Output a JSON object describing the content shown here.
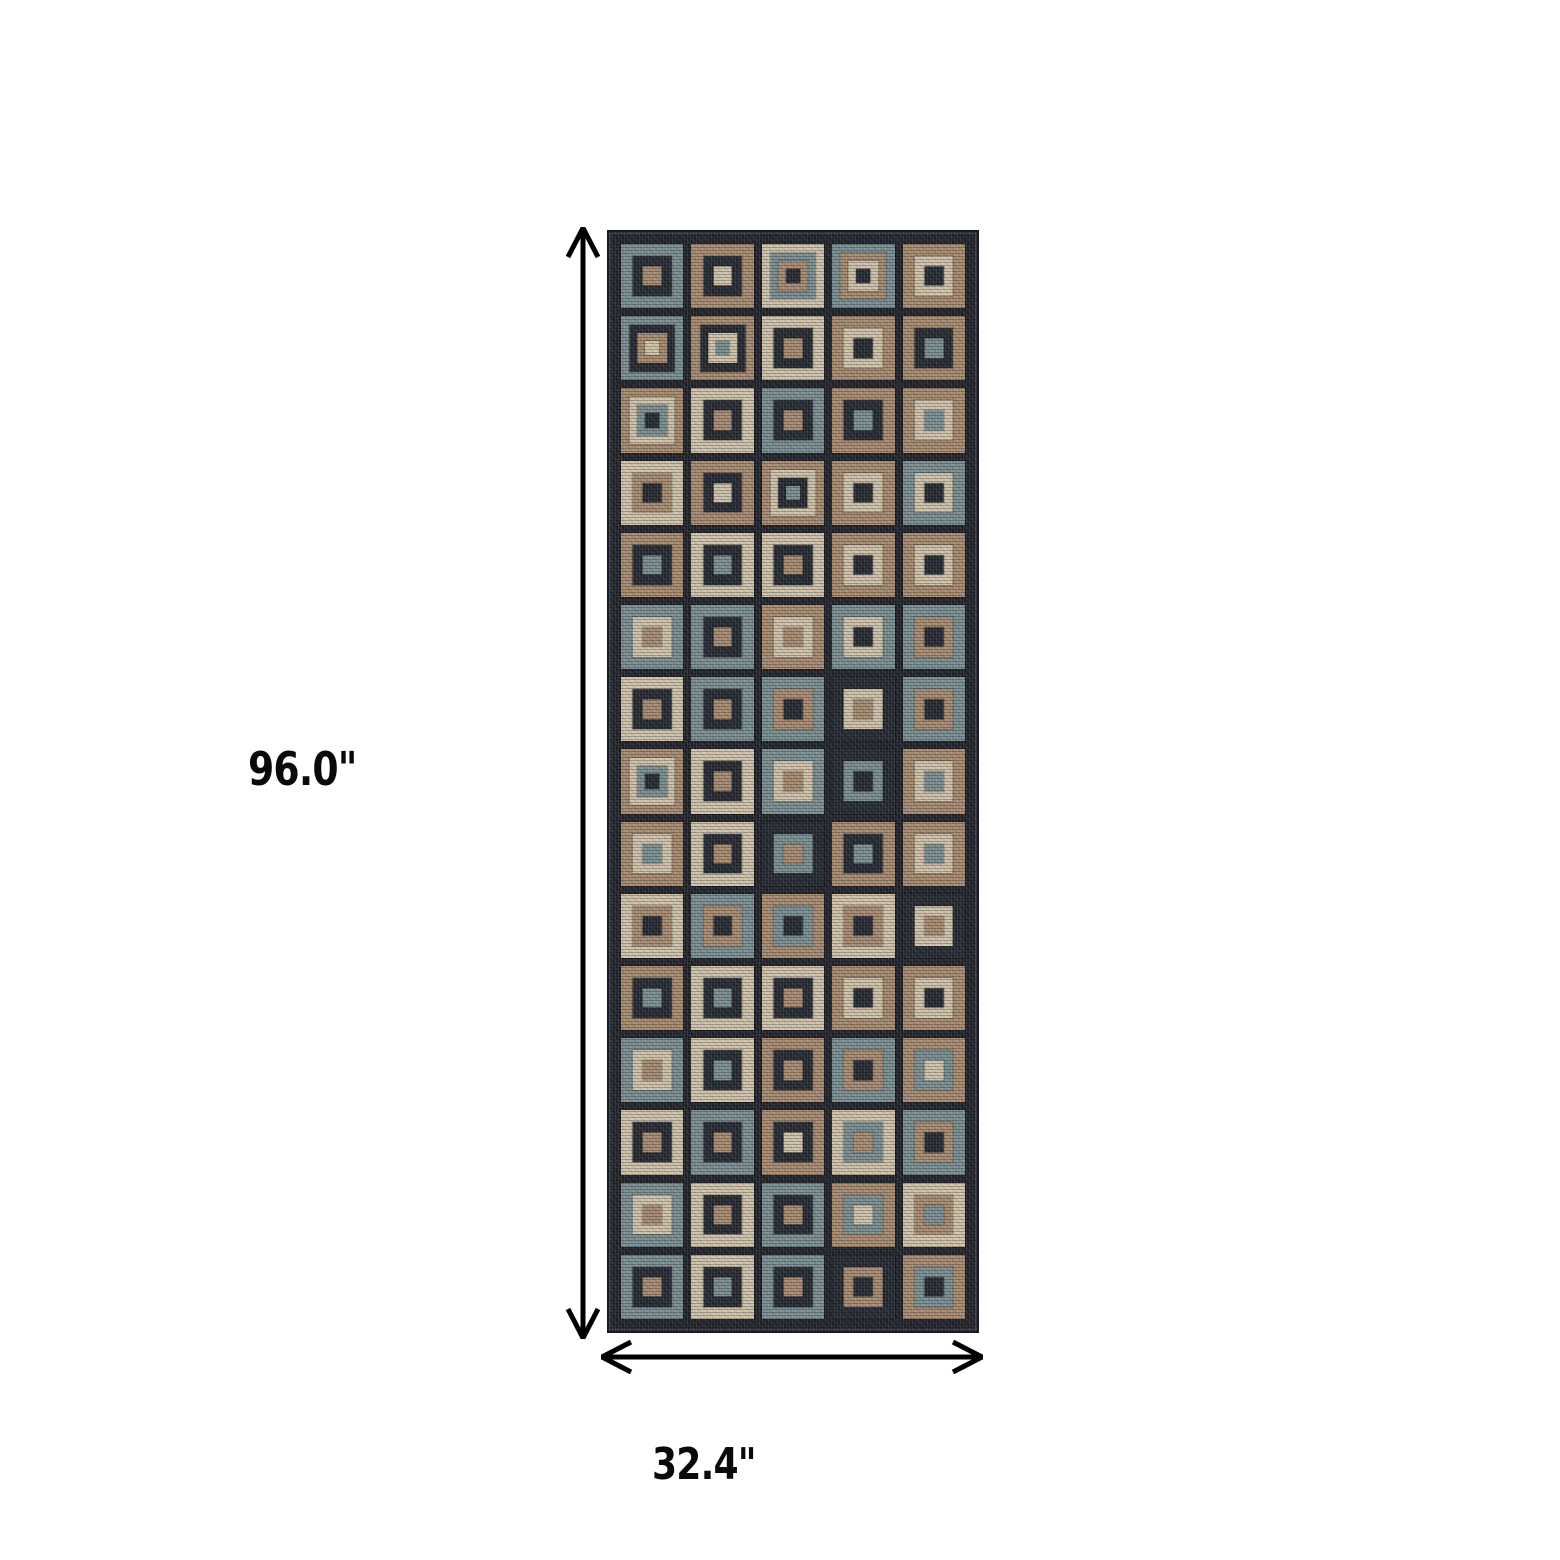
{
  "page": {
    "background": "#ffffff"
  },
  "labels": {
    "height": "96.0\"",
    "width": "32.4\""
  },
  "arrows": {
    "color": "#000000",
    "style": "double-headed"
  },
  "rug": {
    "rows": 15,
    "cols": 5,
    "ground": "#23262e",
    "edge": "#161a22",
    "palette": {
      "N": "#272b34",
      "T": "#7b9093",
      "A": "#a98c72",
      "C": "#d2c5ad"
    },
    "palette_names": {
      "N": "navy",
      "T": "teal",
      "A": "tan",
      "C": "cream"
    },
    "cells": [
      [
        "TNA",
        "ANC",
        "CTAN",
        "TACN",
        "ACN"
      ],
      [
        "TNAC",
        "ANCT",
        "CNA",
        "ACN",
        "ANT"
      ],
      [
        "ACTN",
        "CNA",
        "TNA",
        "ANT",
        "ACT"
      ],
      [
        "CAN",
        "ANC",
        "ACNT",
        "ACN",
        "TCN"
      ],
      [
        "ANT",
        "CNT",
        "CNA",
        "ACN",
        "ACN"
      ],
      [
        "TCA",
        "TNA",
        "ACA",
        "TCN",
        "TAN"
      ],
      [
        "CNA",
        "TNA",
        "TAN",
        "NCA",
        "TAN"
      ],
      [
        "ACTN",
        "CNA",
        "TCA",
        "NTN",
        "ACT"
      ],
      [
        "ACT",
        "CNA",
        "NTA",
        "ANT",
        "ACT"
      ],
      [
        "CAN",
        "TAN",
        "ATN",
        "CAN",
        "NCA"
      ],
      [
        "ANT",
        "CNT",
        "CNA",
        "ACN",
        "ACN"
      ],
      [
        "TCA",
        "CNT",
        "ANA",
        "TAN",
        "ATC"
      ],
      [
        "CNA",
        "TNA",
        "ANC",
        "CTA",
        "TAN"
      ],
      [
        "TCA",
        "CNA",
        "TNA",
        "ATC",
        "CAT"
      ],
      [
        "TNA",
        "CNT",
        "TNA",
        "NAN",
        "ATN"
      ]
    ]
  }
}
